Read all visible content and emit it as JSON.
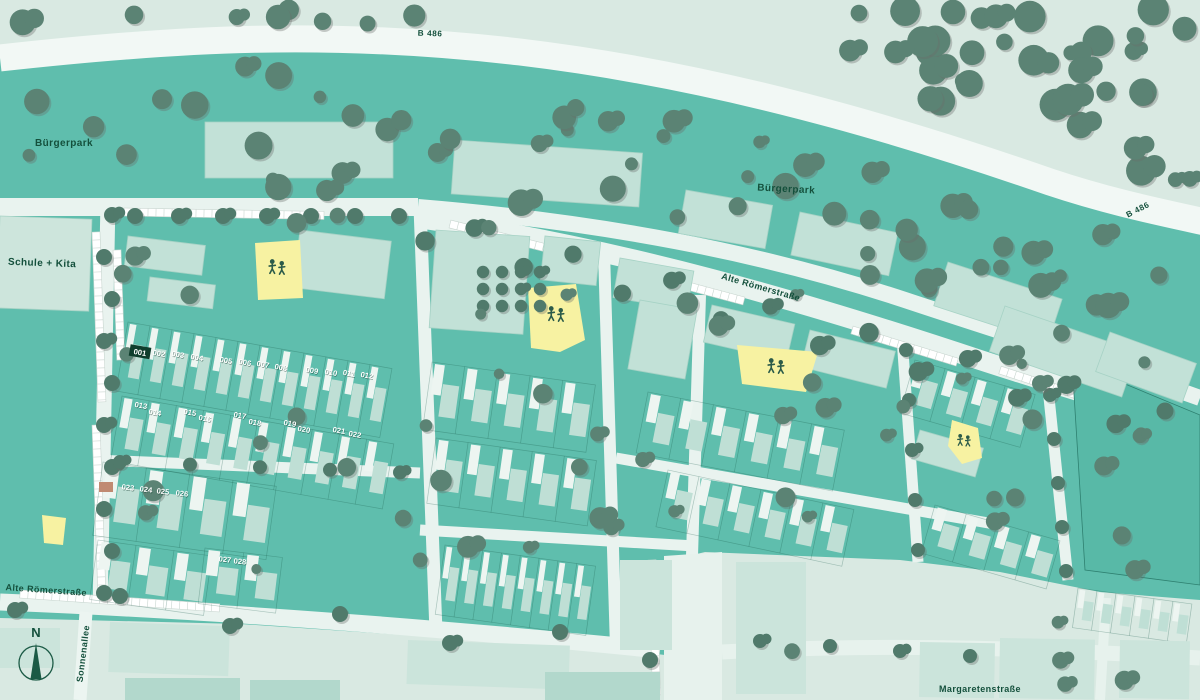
{
  "map": {
    "type": "site-development-plan",
    "labels": {
      "b486_west": "B 486",
      "b486_east": "B 486",
      "buergerpark_west": "Bürgerpark",
      "buergerpark_east": "Bürgerpark",
      "schule_kita": "Schule + Kita",
      "alte_roemerstrasse_main": "Alte Römerstraße",
      "alte_roemerstrasse_west": "Alte Römerstraße",
      "sonnenallee": "Sonnenallee",
      "margaretenstrasse": "Margaretenstraße",
      "compass_north": "N"
    },
    "plots": {
      "selected": "001",
      "numbers": [
        "001",
        "002",
        "003",
        "004",
        "005",
        "006",
        "007",
        "008",
        "009",
        "010",
        "011",
        "012",
        "013",
        "014",
        "015",
        "016",
        "017",
        "018",
        "019",
        "020",
        "021",
        "022",
        "023",
        "024",
        "025",
        "026",
        "027",
        "028"
      ]
    },
    "playgrounds": {
      "count": 5,
      "icon": "children-playing-icon"
    },
    "colors": {
      "site_teal": "#5fbead",
      "outside_pale": "#d9e9e2",
      "road_white": "#f2f8f5",
      "street_light": "#e9f3ef",
      "building_pale": "#c2e1d7",
      "building_outer_pale": "#cbe4db",
      "tree_green": "#5b8374",
      "street_tree_green": "#507a6b",
      "playground_yellow": "#f7f2a2",
      "selected_plot_dark": "#0f3e2d",
      "label_green": "#14503c",
      "meadow_teal": "#58b9a7",
      "accent_brown": "#c08a72"
    }
  }
}
